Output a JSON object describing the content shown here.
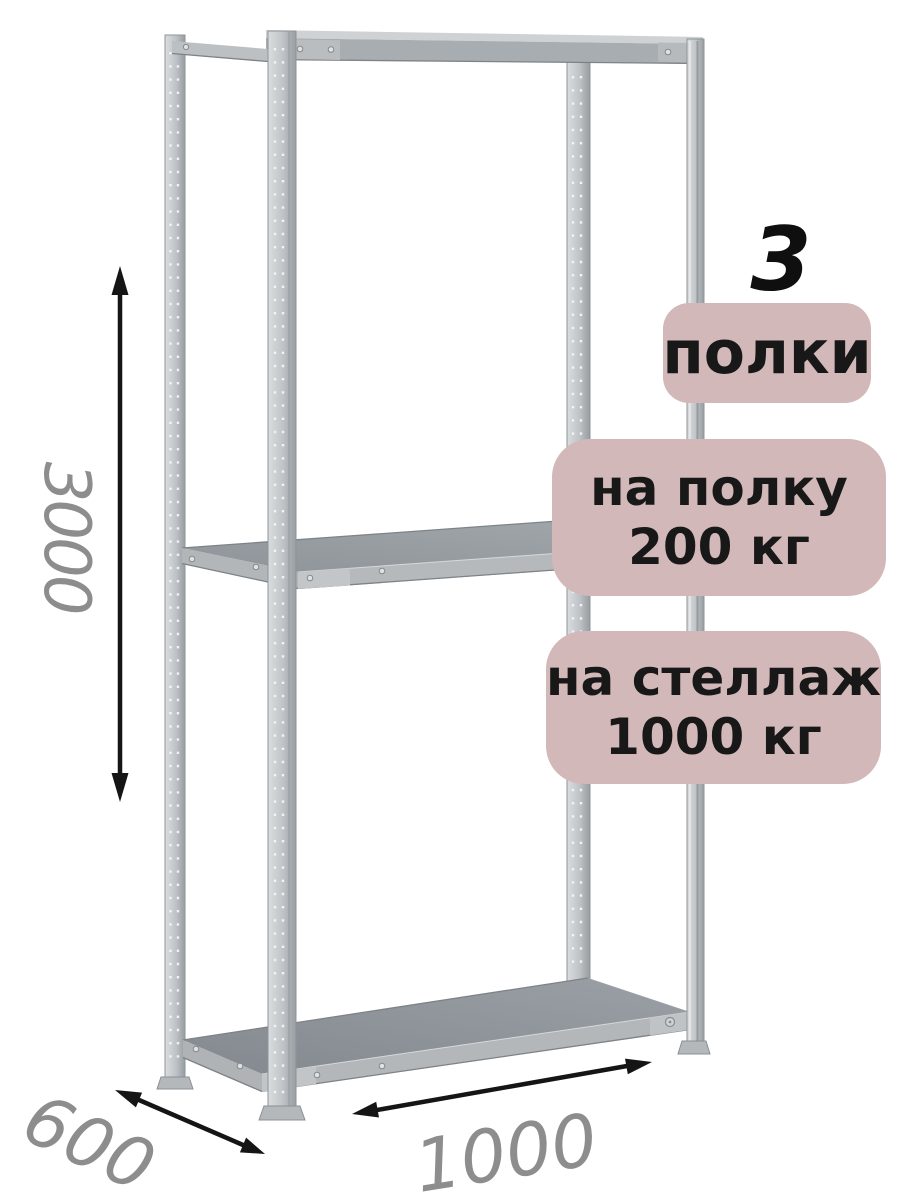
{
  "image": {
    "type": "product-dimension-diagram",
    "subject": "metal shelving rack with three shelves"
  },
  "badges": {
    "count": "3",
    "shelves_label": "полки",
    "per_shelf": {
      "line1": "на полку",
      "line2": "200 кг"
    },
    "per_rack": {
      "line1": "на стеллаж",
      "line2": "1000 кг"
    }
  },
  "dimensions": {
    "height": "3000",
    "depth": "600",
    "width": "1000"
  },
  "colors": {
    "badge_bg": "#d2b8b8",
    "badge_text": "#181818",
    "count_text": "#0f0f0f",
    "dimension_text": "#8d8d8d",
    "arrow": "#151515",
    "background": "#ffffff",
    "metal_light": "#c6cacd",
    "metal_mid": "#a8adb1",
    "metal_dark": "#8c9297"
  }
}
